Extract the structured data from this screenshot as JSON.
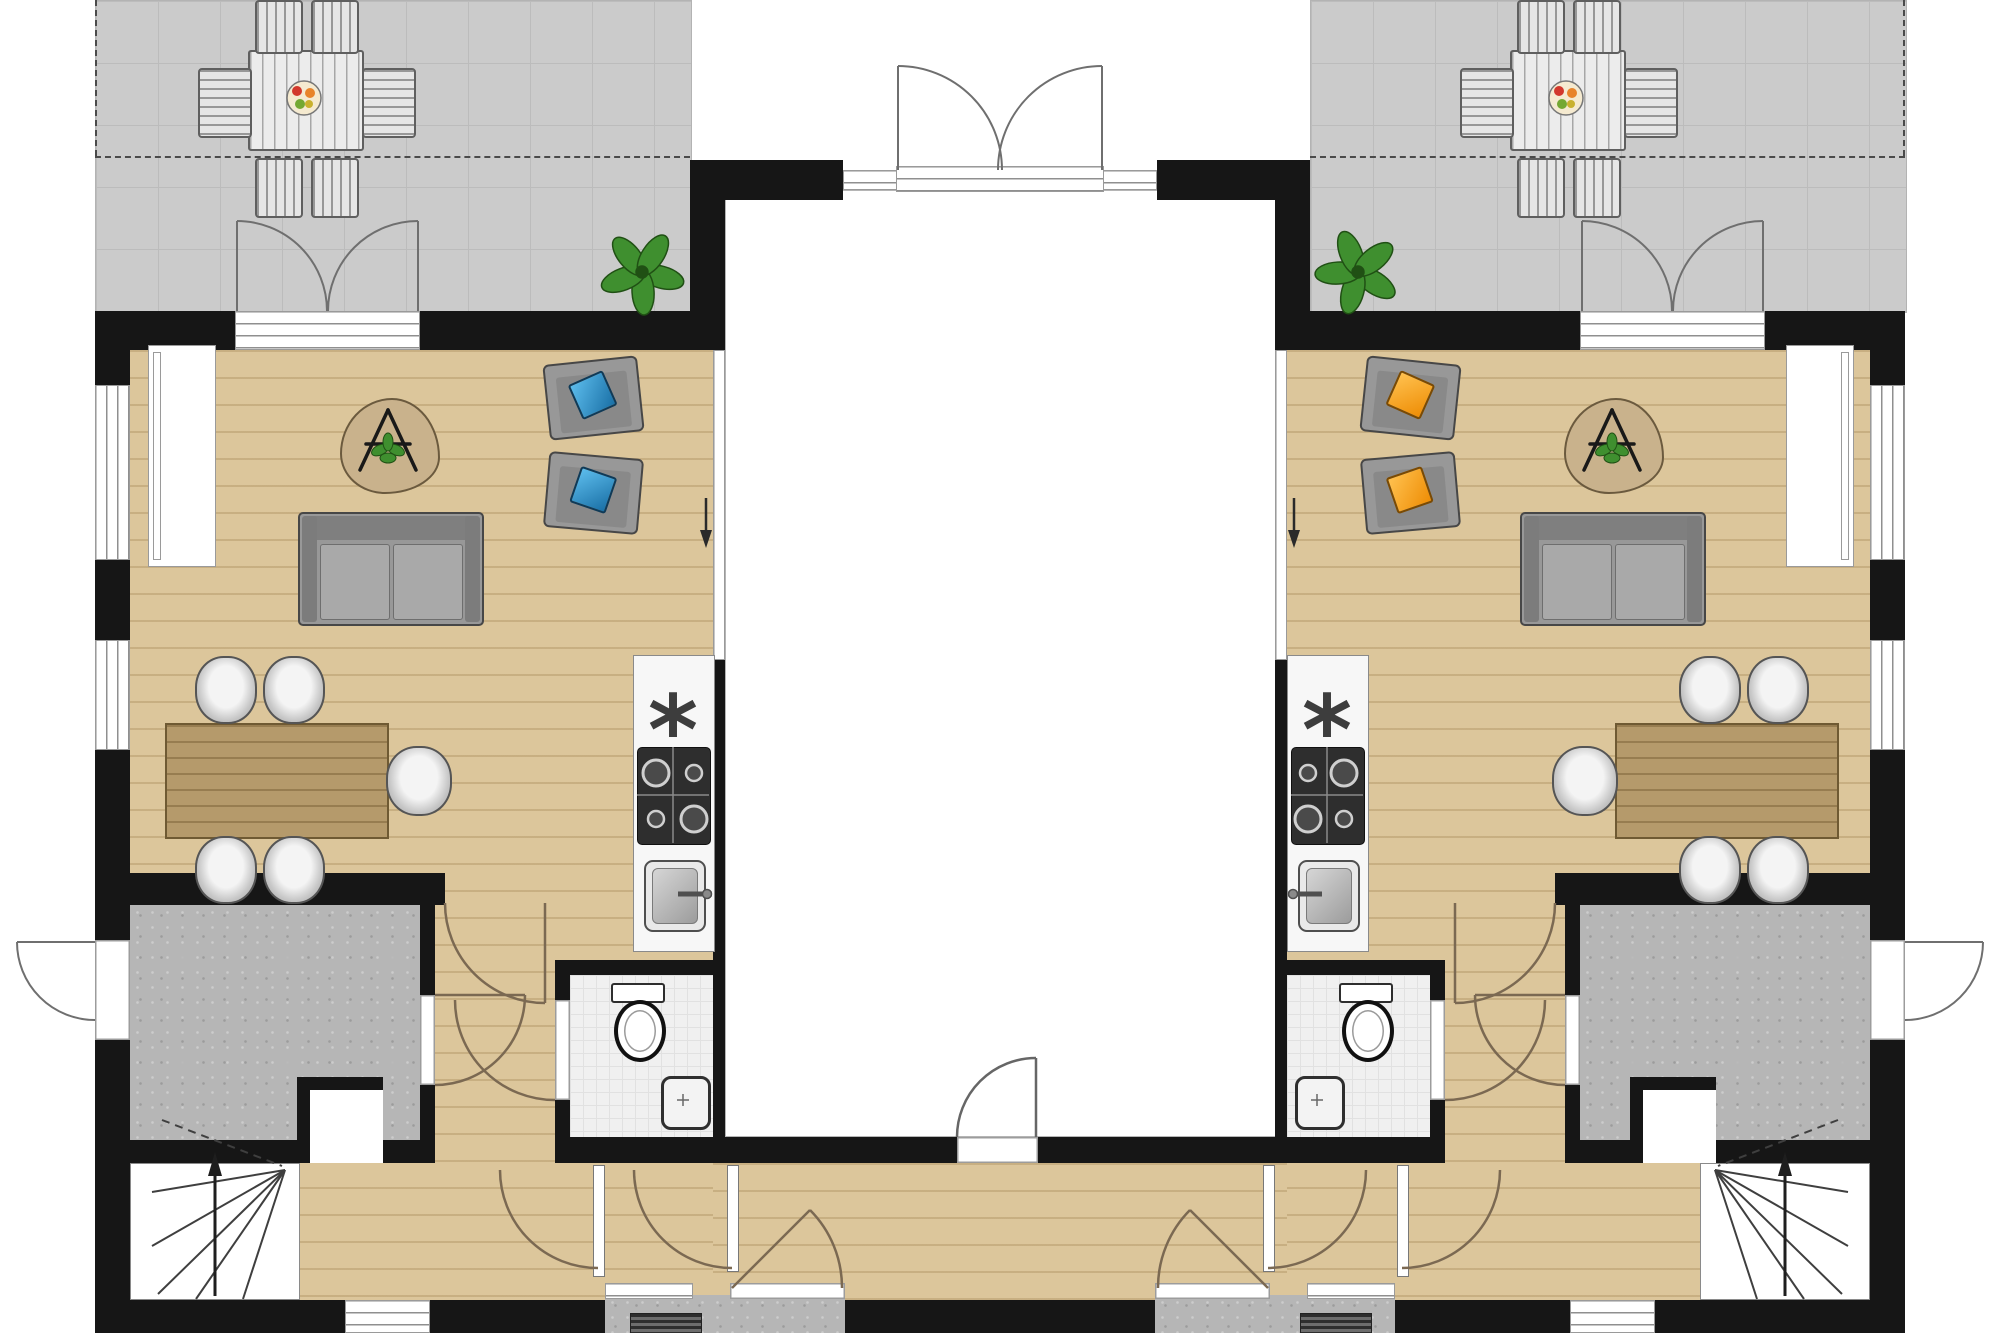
{
  "document": {
    "kind": "architectural floor plan",
    "visible_text_labels": []
  },
  "icons": {
    "kitchen_appliance_asterisk": "*"
  },
  "colors": {
    "wall": "#161616",
    "wood": "#dcc69b",
    "wood-line": "rgba(146,115,63,0.28)",
    "tile": "#cbcbcb",
    "tile-line": "#bcbcbc",
    "concrete": "#b6b6b6",
    "bath-tile": "#f0f0f0",
    "bath-tile-line": "#e1e1e1",
    "door-arc": "#7b6952",
    "door-arc-ext": "#6f6f6f",
    "furn": "#989898",
    "furn-border": "#474747",
    "table-wood": "#b59a6b",
    "table-border": "#6f5a33",
    "pillow-blue-1": "#5cbcec",
    "pillow-blue-2": "#1a70a6",
    "pillow-orange-1": "#ffc14f",
    "pillow-orange-2": "#ee8d05",
    "plant": "#3f8f2f",
    "plant-dark": "#205014",
    "rug": "#c9b28c",
    "rug-border": "#6b5a3e"
  },
  "plan_data": {
    "type": "floor-plan",
    "units": 2,
    "mirrored_about_x": 1000,
    "rooms": [
      {
        "name": "terrace-left",
        "bbox": [
          95,
          0,
          595,
          311
        ],
        "floor": "tile"
      },
      {
        "name": "terrace-right",
        "bbox": [
          1310,
          0,
          595,
          311
        ],
        "floor": "tile"
      },
      {
        "name": "living-dining-left",
        "bbox": [
          130,
          350,
          583,
          523
        ],
        "floor": "wood"
      },
      {
        "name": "living-dining-right",
        "bbox": [
          1287,
          350,
          583,
          523
        ],
        "floor": "wood"
      },
      {
        "name": "kitchen-left",
        "bbox": [
          633,
          655,
          80,
          295
        ],
        "floor": "counter"
      },
      {
        "name": "kitchen-right",
        "bbox": [
          1287,
          655,
          80,
          295
        ],
        "floor": "counter"
      },
      {
        "name": "central-hall",
        "bbox": [
          725,
          190,
          562,
          947
        ],
        "floor": "white"
      },
      {
        "name": "bathroom-left",
        "bbox": [
          570,
          975,
          143,
          162
        ],
        "floor": "bath-tile"
      },
      {
        "name": "bathroom-right",
        "bbox": [
          1287,
          975,
          143,
          162
        ],
        "floor": "bath-tile"
      },
      {
        "name": "storage-left",
        "bbox": [
          130,
          905,
          290,
          235
        ],
        "floor": "concrete"
      },
      {
        "name": "storage-right",
        "bbox": [
          1580,
          905,
          290,
          235
        ],
        "floor": "concrete"
      },
      {
        "name": "stairs-left",
        "bbox": [
          130,
          1163,
          170,
          137
        ]
      },
      {
        "name": "stairs-right",
        "bbox": [
          1700,
          1163,
          170,
          137
        ]
      },
      {
        "name": "hallway-left",
        "bbox": [
          130,
          873,
          583,
          427
        ],
        "floor": "wood"
      },
      {
        "name": "hallway-right",
        "bbox": [
          1287,
          873,
          583,
          427
        ],
        "floor": "wood"
      },
      {
        "name": "porch-left",
        "bbox": [
          605,
          1295,
          240,
          38
        ],
        "floor": "concrete"
      },
      {
        "name": "porch-right",
        "bbox": [
          1155,
          1295,
          240,
          38
        ],
        "floor": "concrete"
      }
    ],
    "furniture": [
      {
        "name": "outdoor-dining-table-left",
        "bbox": [
          248,
          50,
          112,
          97
        ],
        "chairs": 6
      },
      {
        "name": "outdoor-dining-table-right",
        "bbox": [
          1510,
          50,
          112,
          97
        ],
        "chairs": 6
      },
      {
        "name": "plant-terrace-left",
        "center": [
          642,
          272
        ]
      },
      {
        "name": "plant-terrace-right",
        "center": [
          1358,
          272
        ]
      },
      {
        "name": "sofa-left",
        "bbox": [
          298,
          512,
          182,
          110
        ]
      },
      {
        "name": "sofa-right",
        "bbox": [
          1520,
          512,
          182,
          110
        ]
      },
      {
        "name": "armchair-left-1",
        "bbox": [
          546,
          360,
          91,
          72
        ],
        "pillow": "blue"
      },
      {
        "name": "armchair-left-2",
        "bbox": [
          546,
          455,
          91,
          72
        ],
        "pillow": "blue"
      },
      {
        "name": "armchair-right-1",
        "bbox": [
          1363,
          360,
          91,
          72
        ],
        "pillow": "orange"
      },
      {
        "name": "armchair-right-2",
        "bbox": [
          1363,
          455,
          91,
          72
        ],
        "pillow": "orange"
      },
      {
        "name": "rug-left",
        "bbox": [
          340,
          398,
          96,
          92
        ]
      },
      {
        "name": "rug-right",
        "bbox": [
          1564,
          398,
          96,
          92
        ]
      },
      {
        "name": "dining-table-left",
        "bbox": [
          165,
          723,
          220,
          112
        ],
        "chairs": 5
      },
      {
        "name": "dining-table-right",
        "bbox": [
          1615,
          723,
          220,
          112
        ],
        "chairs": 5
      },
      {
        "name": "stove-left",
        "bbox": [
          637,
          747,
          72,
          96
        ]
      },
      {
        "name": "stove-right",
        "bbox": [
          1291,
          747,
          72,
          96
        ]
      },
      {
        "name": "kitchen-sink-left",
        "bbox": [
          644,
          860,
          58,
          68
        ]
      },
      {
        "name": "kitchen-sink-right",
        "bbox": [
          1298,
          860,
          58,
          68
        ]
      },
      {
        "name": "toilet-left",
        "bbox": [
          611,
          983,
          50,
          71
        ]
      },
      {
        "name": "toilet-right",
        "bbox": [
          1339,
          983,
          50,
          71
        ]
      },
      {
        "name": "washbasin-left",
        "bbox": [
          661,
          1076,
          44,
          48
        ]
      },
      {
        "name": "washbasin-right",
        "bbox": [
          1295,
          1076,
          44,
          48
        ]
      },
      {
        "name": "shaft-left",
        "bbox": [
          297,
          1077,
          73,
          73
        ]
      },
      {
        "name": "shaft-right",
        "bbox": [
          1630,
          1077,
          73,
          73
        ]
      }
    ],
    "doors": {
      "french_doors_terrace": 2,
      "central_hall_double_door": 1,
      "central_hall_rear_door": 1,
      "exterior_side_doors": 2,
      "front_doors": 2,
      "interior_single_doors": 10
    },
    "windows": {
      "side_wall": 4,
      "rear_wall": 2,
      "glazed_partitions": 3
    }
  }
}
